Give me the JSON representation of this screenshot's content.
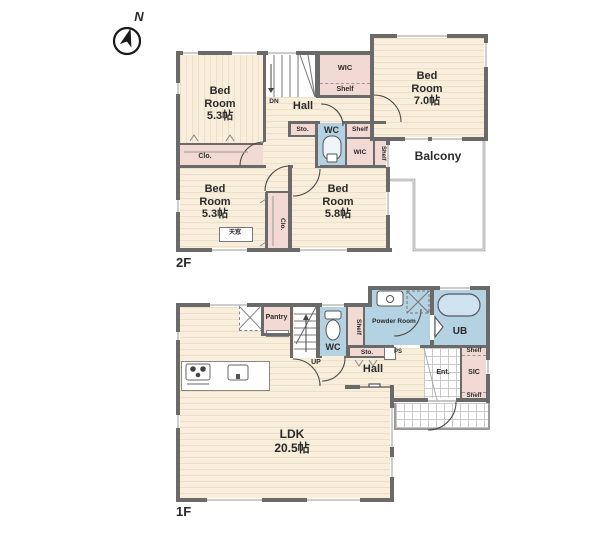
{
  "meta": {
    "compass_label": "N",
    "palette": {
      "room_fill": "#f9eedb",
      "closet_fill": "#f3d9d3",
      "wet_area_fill": "#b5d2e3",
      "wall_color": "#6a6a6a"
    }
  },
  "floor2": {
    "floor_label": "2F",
    "bedroom_nw": {
      "name": "Bed Room",
      "size": "5.3帖"
    },
    "bedroom_ne": {
      "name": "Bed Room",
      "size": "7.0帖"
    },
    "bedroom_sw": {
      "name": "Bed Room",
      "size": "5.3帖"
    },
    "bedroom_se": {
      "name": "Bed Room",
      "size": "5.8帖"
    },
    "hall": "Hall",
    "stairs_dn": "DN",
    "wic_north": "WIC",
    "shelf_north": "Shelf",
    "storage": "Sto.",
    "wc": "WC",
    "shelf_mid": "Shelf",
    "wic_mid": "WIC",
    "shelf_east": "Shelf",
    "closet_nw": "Clo.",
    "closet_mid": "Clo.",
    "skylight": "天窓",
    "balcony": "Balcony"
  },
  "floor1": {
    "floor_label": "1F",
    "ldk": {
      "name": "LDK",
      "size": "20.5帖"
    },
    "pantry": "Pantry",
    "stairs_up": "UP",
    "wc": "WC",
    "shelf_wc": "Shelf",
    "powder_room": "Powder Room",
    "ub": "UB",
    "storage": "Sto.",
    "ps": "PS",
    "hall": "Hall",
    "entrance": "Ent.",
    "sic": "SIC",
    "shelf_sic_top": "Shelf",
    "shelf_sic_bottom": "Shelf"
  }
}
